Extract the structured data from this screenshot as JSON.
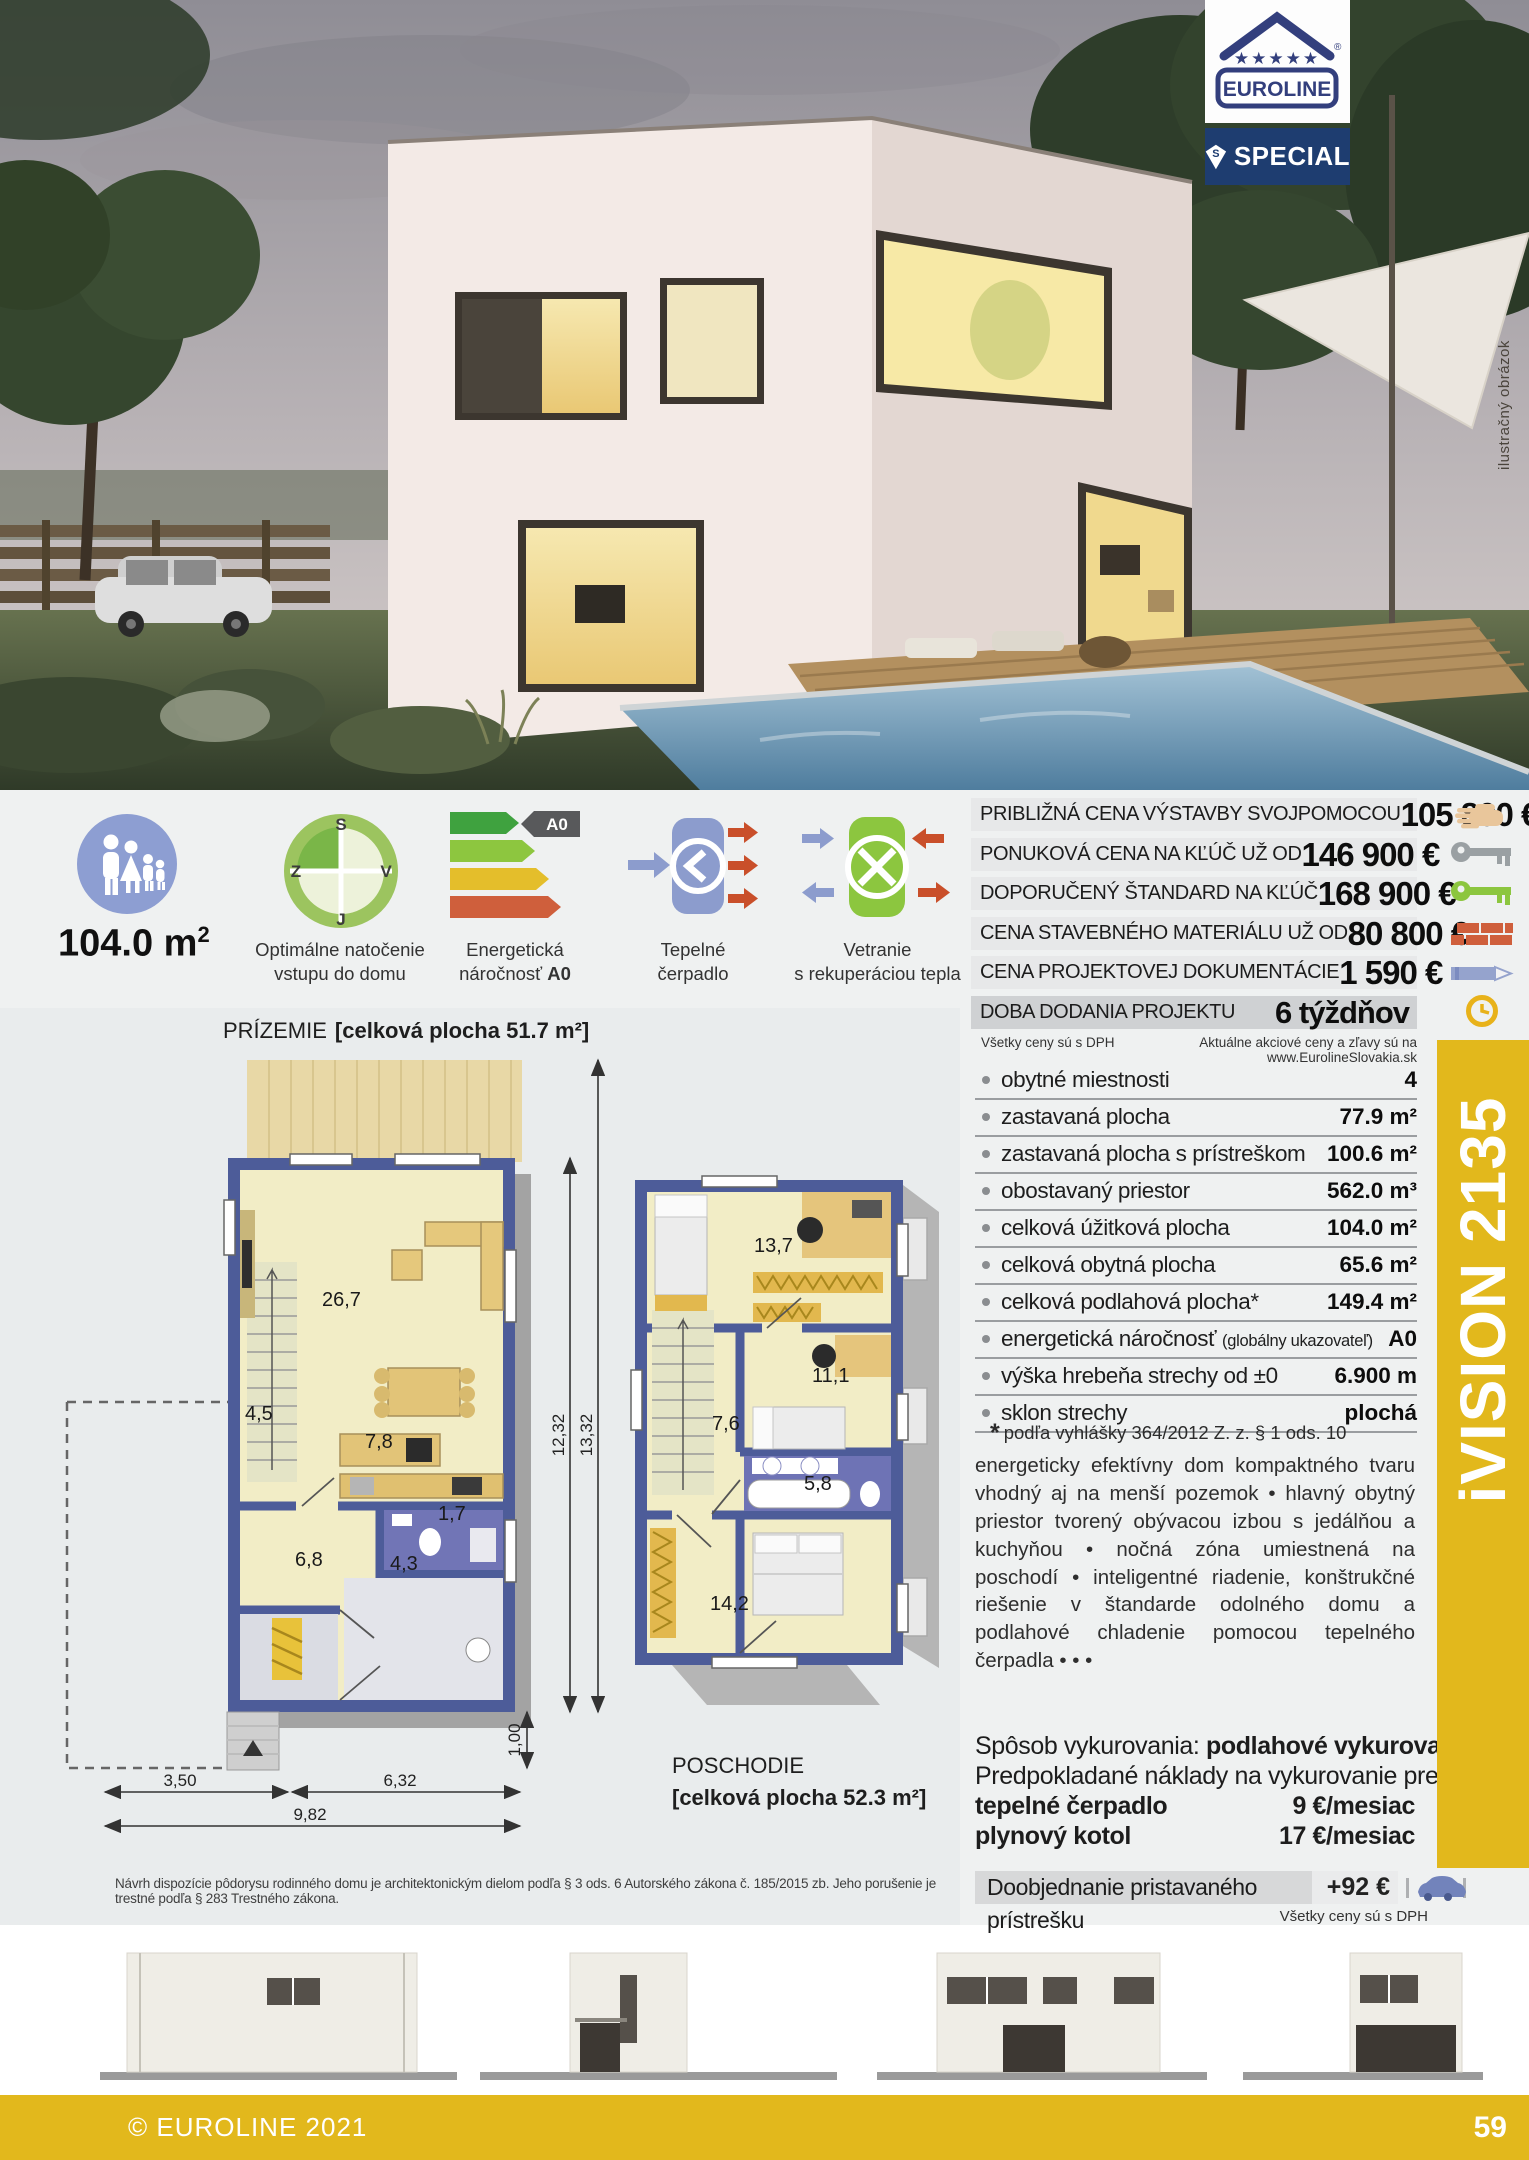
{
  "brand": {
    "name": "EUROLINE",
    "registered": "®",
    "special": "SPECIAL",
    "special_initial": "S"
  },
  "photo": {
    "caption": "ilustračný obrázok"
  },
  "model": {
    "name": "iVISION 2135"
  },
  "features": {
    "area_value": "104.0 m",
    "area_sup": "2",
    "compass": {
      "top": "S",
      "left": "Z",
      "right": "V",
      "bottom": "J",
      "caption_line1": "Optimálne natočenie",
      "caption_line2": "vstupu do domu"
    },
    "energy": {
      "badge": "A0",
      "caption_line1": "Energetická",
      "caption_line2_prefix": "náročnosť ",
      "caption_line2_bold": "A0"
    },
    "heat_pump": {
      "caption_line1": "Tepelné",
      "caption_line2": "čerpadlo"
    },
    "ventilation": {
      "caption_line1": "Vetranie",
      "caption_line2": "s rekuperáciou tepla"
    }
  },
  "price_table": {
    "rows": [
      {
        "label": "PRIBLIŽNÁ CENA VÝSTAVBY SVOJPOMOCOU",
        "value": "105 800 €"
      },
      {
        "label": "PONUKOVÁ CENA NA KĽÚČ UŽ OD",
        "value": "146 900 €"
      },
      {
        "label": "DOPORUČENÝ ŠTANDARD NA KĽÚČ",
        "value": "168 900 €"
      },
      {
        "label": "CENA STAVEBNÉHO MATERIÁLU UŽ OD",
        "value": "80 800 €"
      },
      {
        "label": "CENA PROJEKTOVEJ DOKUMENTÁCIE",
        "value": "1 590 €"
      },
      {
        "label": "DOBA DODANIA PROJEKTU",
        "value": "6 týždňov"
      }
    ],
    "note_left": "Všetky ceny sú s DPH",
    "note_right": "Aktuálne akciové ceny a zľavy sú na www.EurolineSlovakia.sk"
  },
  "specs": {
    "rows": [
      {
        "label": "obytné miestnosti",
        "value": "4"
      },
      {
        "label": "zastavaná plocha",
        "value": "77.9 m²"
      },
      {
        "label": "zastavaná plocha s prístreškom",
        "value": "100.6 m²"
      },
      {
        "label": "obostavaný priestor",
        "value": "562.0 m³"
      },
      {
        "label": "celková úžitková plocha",
        "value": "104.0 m²"
      },
      {
        "label": "celková obytná plocha",
        "value": "65.6 m²"
      },
      {
        "label": "celková podlahová plocha*",
        "value": "149.4 m²"
      },
      {
        "label": "energetická náročnosť ",
        "label_note": "(globálny ukazovateľ)",
        "value": "A0"
      },
      {
        "label": "výška hrebeňa strechy od ±0",
        "value": "6.900 m"
      },
      {
        "label": "sklon strechy",
        "value": "plochá"
      }
    ],
    "footnote_mark": "*",
    "footnote_text": "podľa vyhlášky 364/2012 Z. z. § 1 ods. 10"
  },
  "description": "energeticky efektívny dom kompaktného tvaru vhodný aj na menší pozemok • hlavný obytný priestor tvorený obývacou izbou s jedálňou a kuchyňou • nočná zóna umiestnená na poschodí • inteligentné riadenie, konštrukčné riešenie v štandarde odolného domu a podlahové chladenie pomocou tepelného čerpadla • • •",
  "heating": {
    "method_label": "Spôsob vykurovania: ",
    "method_value": "podlahové vykurovanie",
    "costs_intro": "Predpokladané náklady na vykurovanie pre zdroj:",
    "rows": [
      {
        "label": "tepelné čerpadlo",
        "value": "9 €/mesiac"
      },
      {
        "label": "plynový kotol",
        "value": "17 €/mesiac"
      }
    ]
  },
  "addon": {
    "label": "Doobjednanie pristavaného prístrešku",
    "value": "+92 €",
    "note": "Všetky ceny sú s DPH"
  },
  "plans": {
    "ground": {
      "title": "PRÍZEMIE",
      "area": "[celková plocha 51.7 m²]",
      "rooms": {
        "living": "26,7",
        "stairs": "4,5",
        "kitchen": "7,8",
        "hall": "6,8",
        "wc": "1,7",
        "tech": "4,3"
      },
      "dims": {
        "left": "3,50",
        "right": "6,32",
        "total": "9,82",
        "height_inner": "12,32",
        "height_total": "13,32",
        "step": "1,00"
      }
    },
    "upper": {
      "title": "POSCHODIE",
      "area": "[celková plocha 52.3 m²]",
      "rooms": {
        "bedroom1": "13,7",
        "bedroom2": "11,1",
        "hall": "7,6",
        "bath": "5,8",
        "bedroom3": "14,2"
      }
    }
  },
  "disclaimer": "Návrh dispozície pôdorysu rodinného domu je architektonickým dielom podľa § 3 ods. 6 Autorského zákona č. 185/2015 zb. Jeho porušenie je trestné podľa § 283 Trestného zákona.",
  "footer": {
    "copyright": "© EUROLINE 2021",
    "page": "59"
  },
  "colors": {
    "accent_yellow": "#e2b81c",
    "navy": "#1e3d70",
    "logo_blue": "#333f7d",
    "wall_blue": "#4d5c99",
    "energy_green": "#3fa23f",
    "energy_red": "#cf5f3c"
  }
}
